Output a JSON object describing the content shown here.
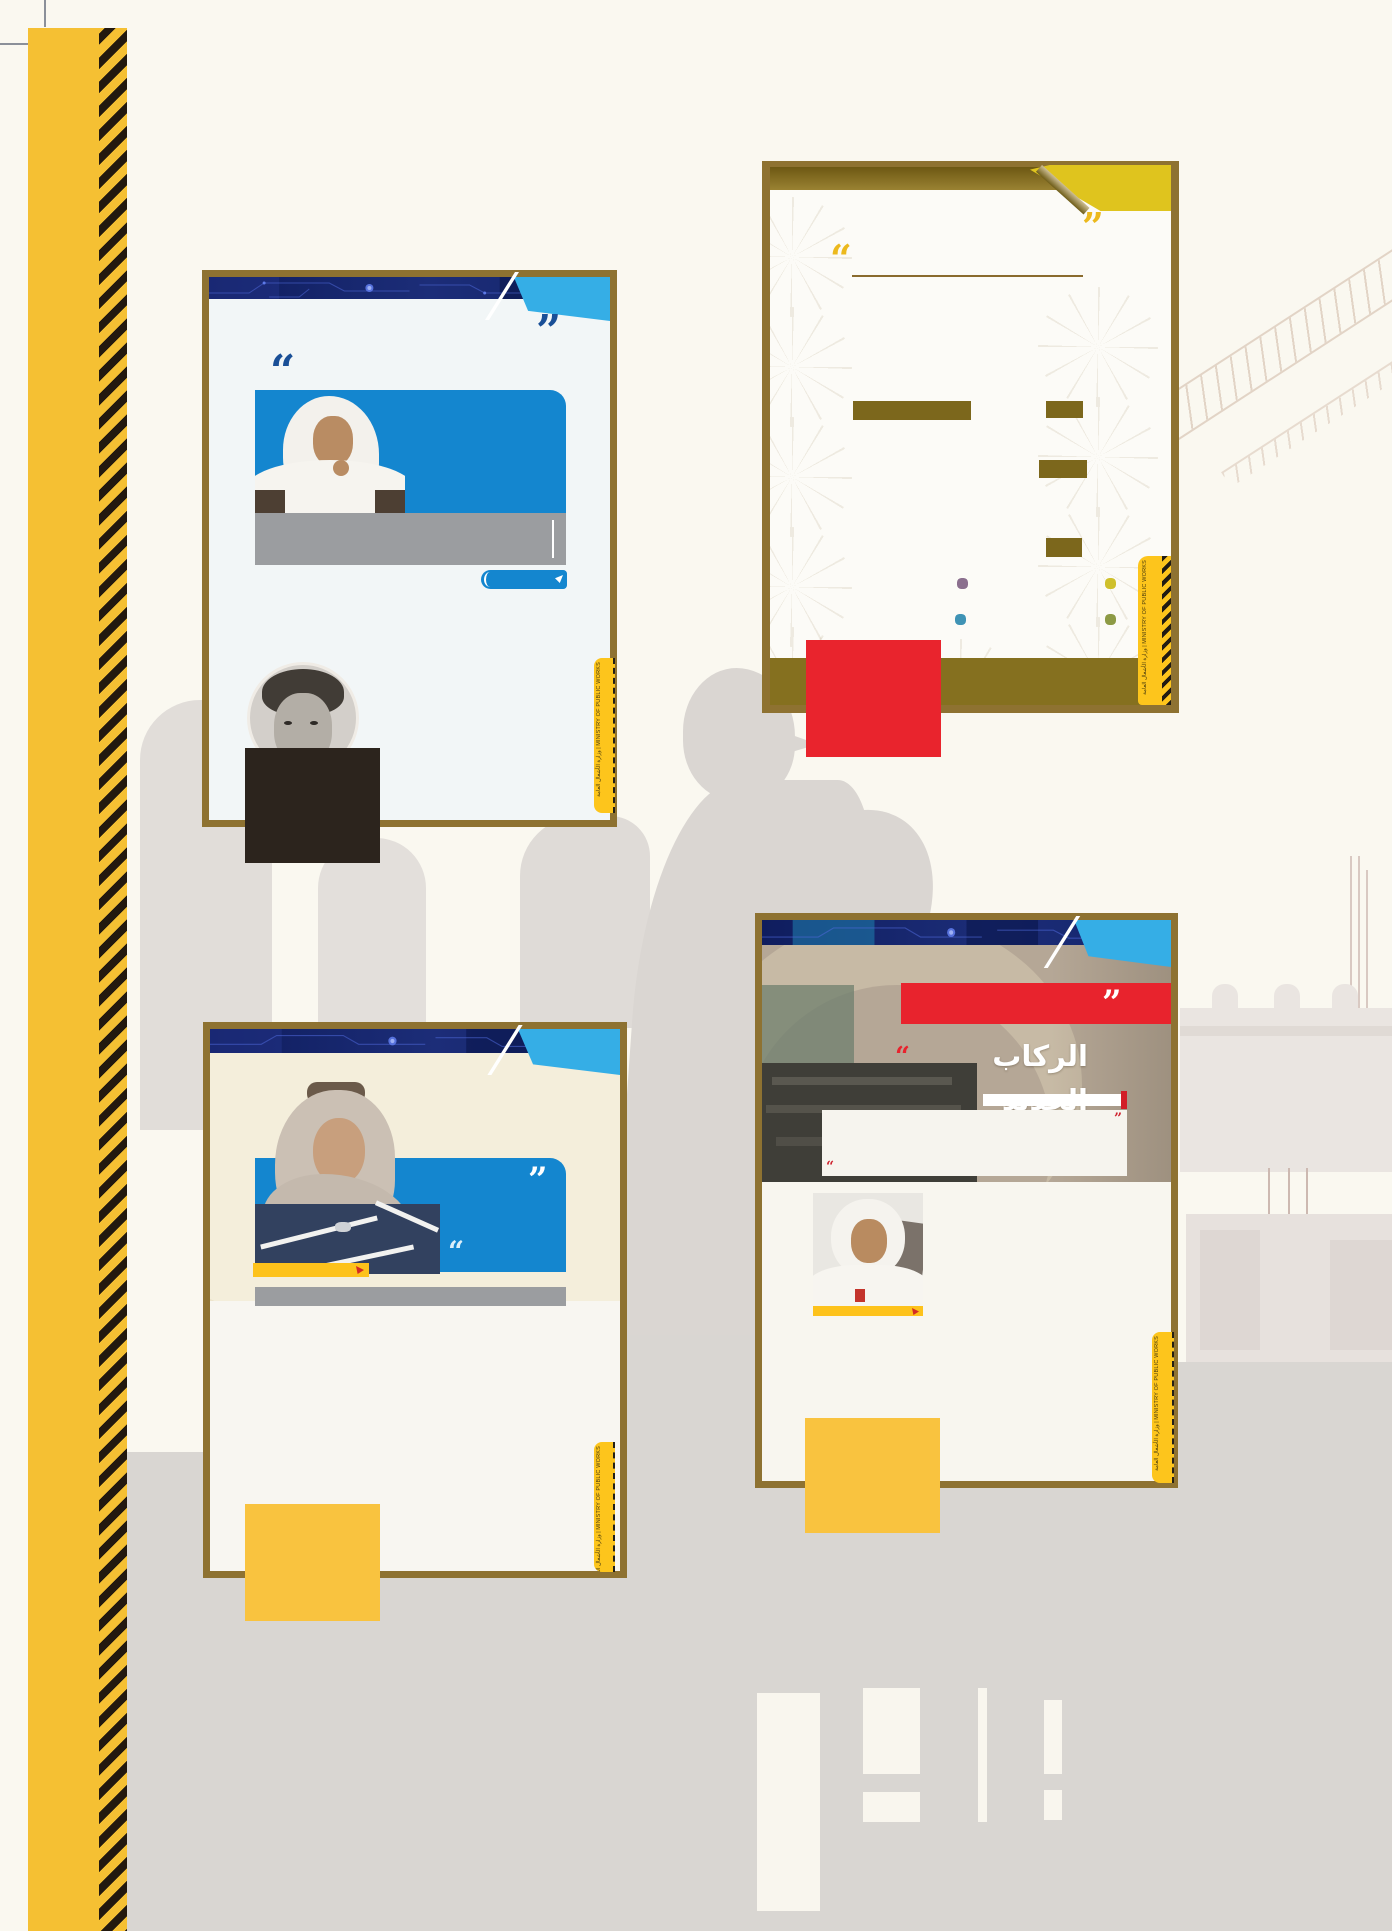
{
  "ministry": {
    "ar": "وزارة الأشغال العامة",
    "en": "MINISTRY OF PUBLIC WORKS",
    "combined": "وزارة الأشغال العامة | MINISTRY OF PUBLIC WORKS"
  },
  "quotes": {
    "open": "“",
    "close": "”"
  },
  "cards": {
    "bottom_right": {
      "title_ar": "الركاب الجديد"
    }
  },
  "colors": {
    "page_cream": "#faf8f0",
    "card_gold_border": "#8e7231",
    "navy_header": "#15246b",
    "light_blue_ribbon": "#35aee6",
    "photo_blue_box": "#1486cf",
    "gray_caption_bar": "#9b9da0",
    "accent_red": "#e8232d",
    "accent_yellow": "#fdc51c",
    "yellow_square": "#f9c33f",
    "olive_band": "#85701f",
    "corner_flag_yellow": "#dfc41e",
    "spine_yellow": "#f5c033",
    "background_gray": "#d9d6d2"
  }
}
